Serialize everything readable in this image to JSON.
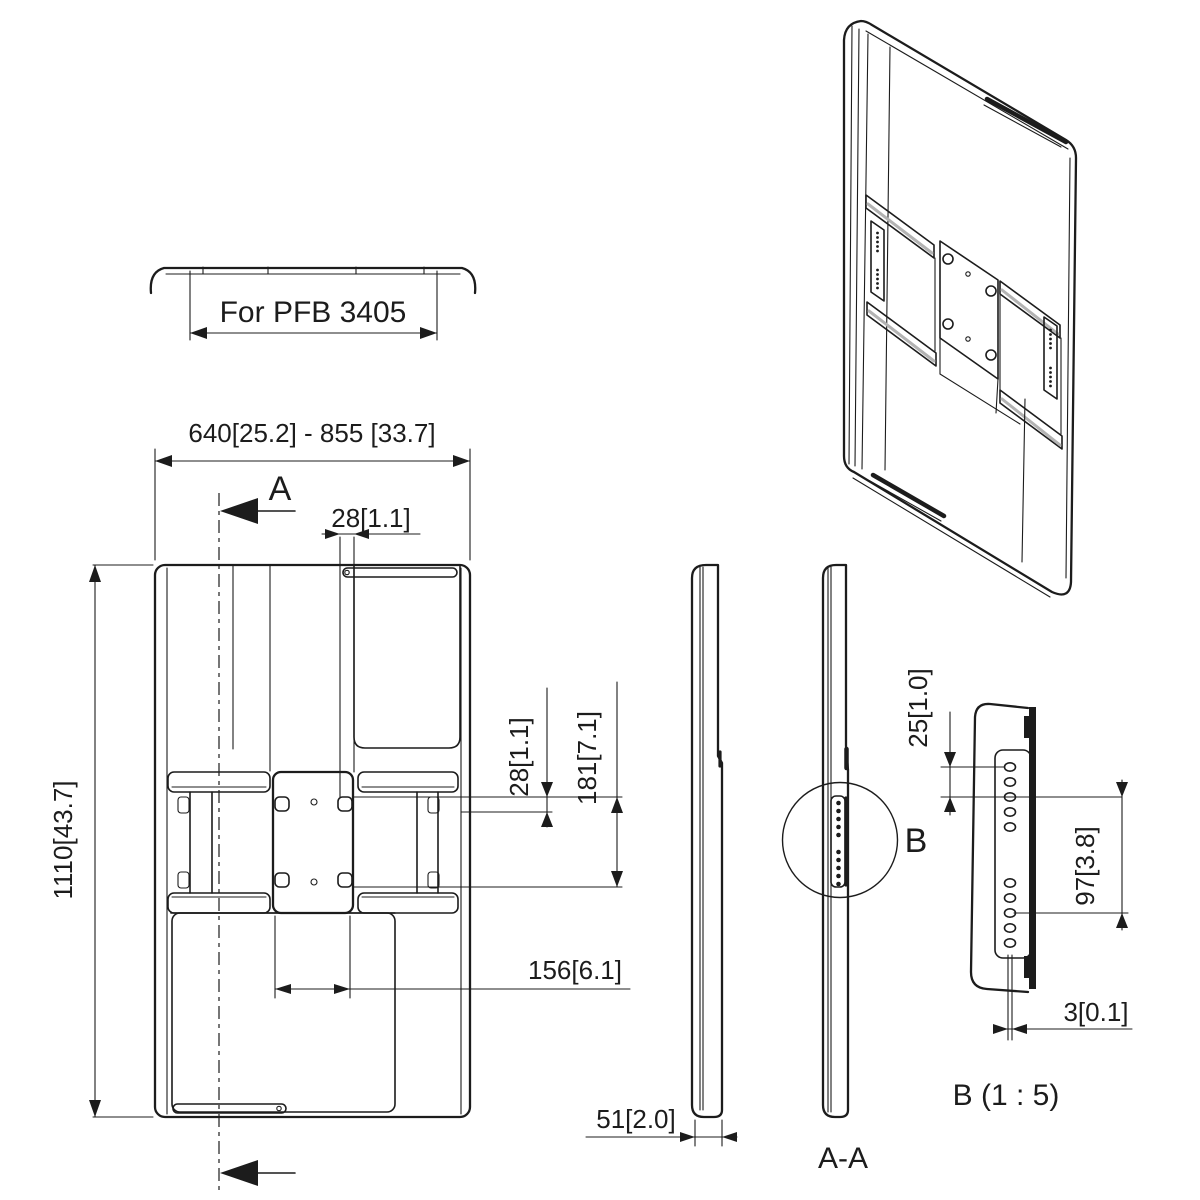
{
  "drawing": {
    "top_view": {
      "label": "For PFB 3405"
    },
    "dims": {
      "width_range": "640[25.2] - 855 [33.7]",
      "height": "1110[43.7]",
      "slot_offset": "28[1.1]",
      "hole_offset": "28[1.1]",
      "hole_span_vertical": "181[7.1]",
      "hole_span_horizontal": "156[6.1]",
      "depth": "51[2.0]",
      "detail_hole_pitch": "25[1.0]",
      "detail_span": "97[3.8]",
      "detail_thickness": "3[0.1]"
    },
    "labels": {
      "section_arrow": "A",
      "section_view": "A-A",
      "detail_marker": "B",
      "detail_view": "B (1 : 5)"
    },
    "colors": {
      "line": "#1c1c1c",
      "background": "#ffffff",
      "rail_band": "#b3b3b3"
    }
  }
}
